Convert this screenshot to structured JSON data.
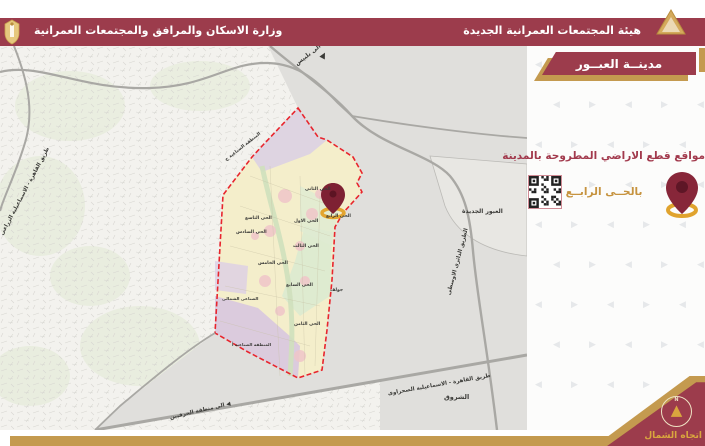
{
  "header": {
    "ministry": "وزارة الاسكان والمرافق والمجتمعات العمرانية",
    "authority": "هيئة المجتمعات العمرانية الجديدة"
  },
  "panel": {
    "city": "مدينــة العبــور",
    "heading": "مواقع قطع الاراضي المطروحة بالمدينة",
    "district": "بالحــى الرابــع",
    "north": "اتجاه الشمال",
    "compass_n": "N",
    "pattern": {
      "left": "◀",
      "right": "▶"
    }
  },
  "icons": {
    "north_arrow": "▲",
    "qr": "qr-code",
    "pin": "location-pin"
  },
  "map_labels": [
    {
      "t": "الى بلبيس",
      "x": 296,
      "y": 61,
      "r": -38,
      "s": 6
    },
    {
      "t": "▲",
      "x": 321,
      "y": 49,
      "r": 28,
      "s": 8
    },
    {
      "t": "العبور الجديدة",
      "x": 462,
      "y": 208,
      "r": 0,
      "s": 6
    },
    {
      "t": "الطريق الدائرى الاوسطى",
      "x": 449,
      "y": 292,
      "r": -75,
      "s": 5.5
    },
    {
      "t": "طريق القاهرة - الاسماعيلية الزراعى",
      "x": 2,
      "y": 232,
      "r": -62,
      "s": 5.5
    },
    {
      "t": "طريق القاهرة - الاسماعيلية الصحراوى",
      "x": 388,
      "y": 391,
      "r": -10,
      "s": 5.5
    },
    {
      "t": "◀ الى منطقة الحرفيين",
      "x": 170,
      "y": 415,
      "r": -13,
      "s": 5.5
    },
    {
      "t": "الشروق",
      "x": 444,
      "y": 393,
      "r": 0,
      "s": 6.5
    },
    {
      "t": "المنطقة الصناعية ج",
      "x": 226,
      "y": 158,
      "r": -38,
      "s": 4.5
    },
    {
      "t": "الحى التاسع",
      "x": 245,
      "y": 216,
      "r": 0,
      "s": 4.5
    },
    {
      "t": "الحى الاول",
      "x": 294,
      "y": 219,
      "r": 0,
      "s": 4.5
    },
    {
      "t": "الحى الثانى",
      "x": 305,
      "y": 187,
      "r": 0,
      "s": 4.5
    },
    {
      "t": "الحى الثالث",
      "x": 293,
      "y": 244,
      "r": 0,
      "s": 4.5
    },
    {
      "t": "الحى الرابع",
      "x": 326,
      "y": 214,
      "r": 0,
      "s": 4.5
    },
    {
      "t": "الحى الخامس",
      "x": 258,
      "y": 261,
      "r": 0,
      "s": 4.5
    },
    {
      "t": "الحى السادس",
      "x": 236,
      "y": 230,
      "r": 0,
      "s": 4.5
    },
    {
      "t": "الحى السابع",
      "x": 286,
      "y": 283,
      "r": 0,
      "s": 4.5
    },
    {
      "t": "الحى الثامن",
      "x": 294,
      "y": 322,
      "r": 0,
      "s": 4.5
    },
    {
      "t": "جولف",
      "x": 330,
      "y": 288,
      "r": 0,
      "s": 4.5
    },
    {
      "t": "الصناعى الشمالى",
      "x": 222,
      "y": 296,
      "r": 0,
      "s": 4.2
    },
    {
      "t": "المنطقة الصناعية أ",
      "x": 232,
      "y": 342,
      "r": 0,
      "s": 4.2
    }
  ],
  "colors": {
    "maroon": "#9c3c4c",
    "gold": "#c49a4f",
    "gold_text": "#c6933f",
    "heading": "#a23a4d",
    "boundary_red": "#e8252d",
    "map_gray": "#e0dfdc",
    "map_bg": "#f3f2ee"
  }
}
